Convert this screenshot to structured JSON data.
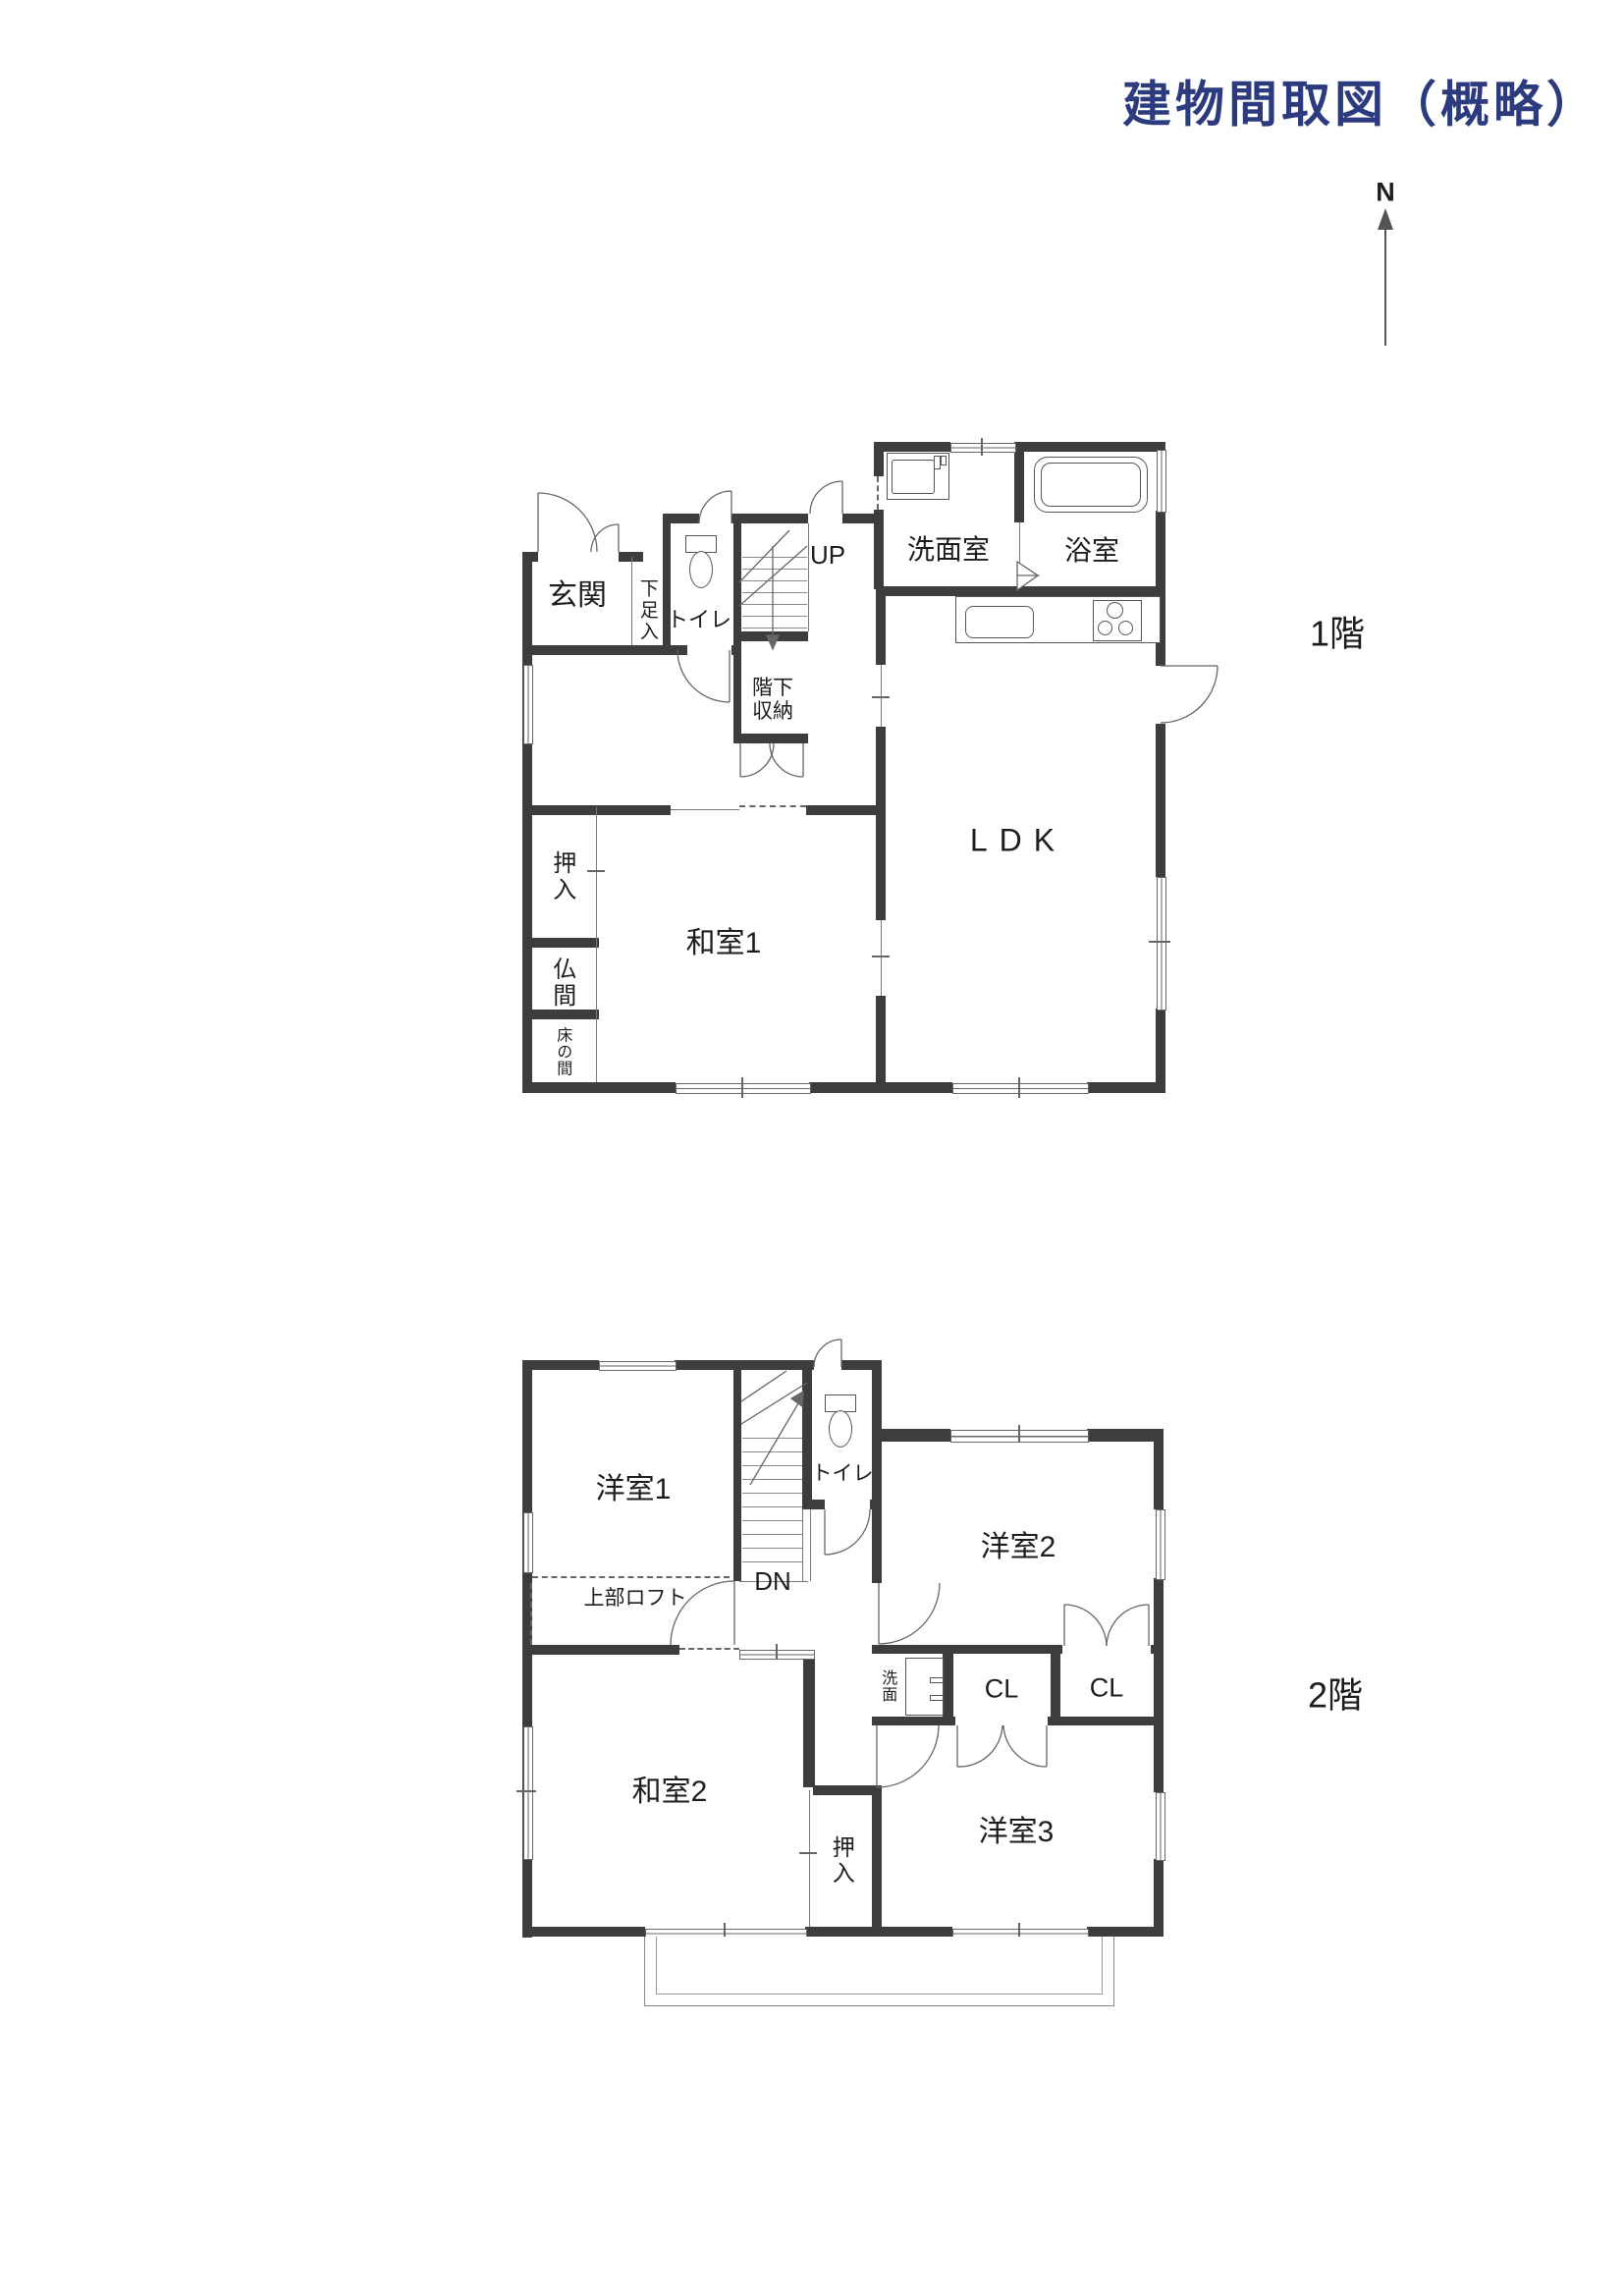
{
  "page": {
    "title": "建物間取図（概略）",
    "compass_label": "N",
    "colors": {
      "title_navy": "#2c3a7e",
      "wall": "#3d3d3d",
      "line": "#666666"
    }
  },
  "floor1": {
    "name": "1階",
    "rooms": {
      "genkan": "玄関",
      "getabako": "下足入",
      "toilet": "トイレ",
      "stairs_up": "UP",
      "understair_storage": "階下収納",
      "washroom": "洗面室",
      "bath": "浴室",
      "ldk": "LDK",
      "oshiire": "押入",
      "butsuma": "仏間",
      "tokonoma": "床の間",
      "washitsu1": "和室1"
    }
  },
  "floor2": {
    "name": "2階",
    "rooms": {
      "yoshitsu1": "洋室1",
      "loft": "上部ロフト",
      "stairs_down": "DN",
      "toilet": "トイレ",
      "yoshitsu2": "洋室2",
      "senmen": "洗面",
      "closet1": "CL",
      "closet2": "CL",
      "washitsu2": "和室2",
      "oshiire": "押入",
      "yoshitsu3": "洋室3",
      "veranda": "ベランダ"
    }
  }
}
